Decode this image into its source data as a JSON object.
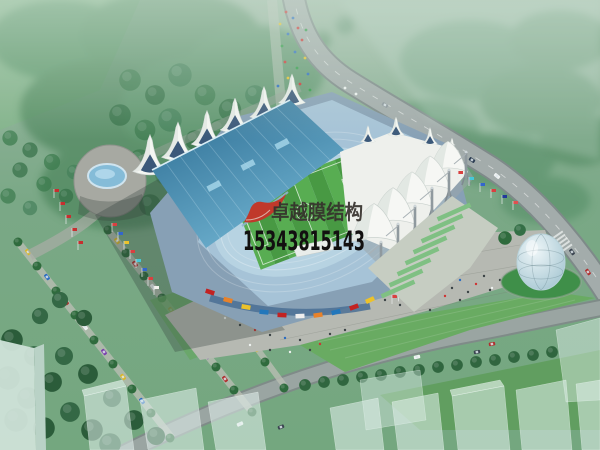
{
  "watermark": {
    "company_name": "卓越膜结构",
    "phone_number": "15343815143",
    "logo_color": "#c0392b",
    "company_text_color": "#35312c",
    "phone_text_color": "#121010"
  },
  "scene": {
    "description": "Aerial architectural rendering of a stadium with white tensile membrane roofs, plazas, roads, tree-lined avenues and a glass egg pavilion",
    "palette": {
      "forest_green": "#3c7a4e",
      "lawn_green": "#69ab62",
      "pitch_green": "#54a74e",
      "running_track_blue": "#b7d3e2",
      "grandstand_roof_teal": "#2a6a90",
      "membrane_white": "#f4f6f2",
      "plaza_gray": "#b6b9b2",
      "road_gray": "#9aa5a2",
      "glass_egg_blue": "#9cc0cd",
      "fountain_blue": "#85bcd8"
    }
  }
}
